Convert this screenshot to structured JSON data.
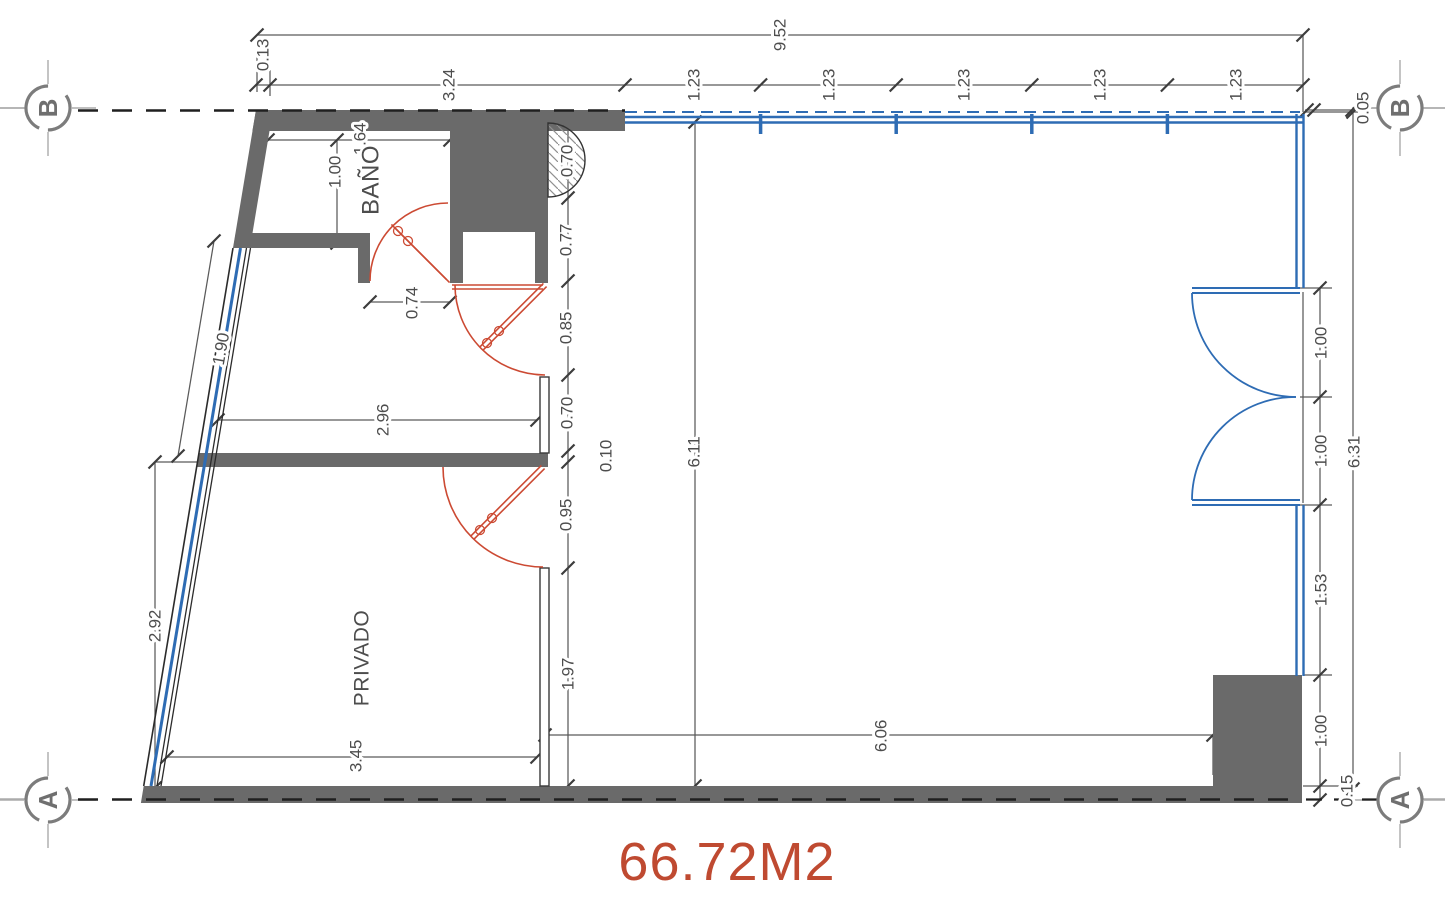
{
  "drawing": {
    "title": "floor plan",
    "area_label": {
      "text": "66.72M2",
      "x": 727,
      "y": 880,
      "size": 54
    },
    "room_labels": [
      {
        "name": "BAÑO",
        "x": 371,
        "y": 180,
        "angle": -90,
        "size": 24
      },
      {
        "name": "PRIVADO",
        "x": 362,
        "y": 658,
        "angle": -90,
        "size": 21
      }
    ],
    "grid_markers": [
      {
        "label": "B",
        "x": 48,
        "y": 108
      },
      {
        "label": "B",
        "x": 1400,
        "y": 108
      },
      {
        "label": "A",
        "x": 48,
        "y": 800
      },
      {
        "label": "A",
        "x": 1400,
        "y": 800
      }
    ],
    "dimensions": [
      {
        "value": "9.52",
        "x": 780,
        "y": 35
      },
      {
        "value": "0.13",
        "x": 263,
        "y": 55
      },
      {
        "value": "3.24",
        "x": 449,
        "y": 85
      },
      {
        "value": "1.23",
        "x": 694,
        "y": 85
      },
      {
        "value": "1.23",
        "x": 829,
        "y": 85
      },
      {
        "value": "1.23",
        "x": 964,
        "y": 85
      },
      {
        "value": "1.23",
        "x": 1100,
        "y": 85
      },
      {
        "value": "1.23",
        "x": 1236,
        "y": 85
      },
      {
        "value": "0.05",
        "x": 1363,
        "y": 108
      },
      {
        "value": "6.31",
        "x": 1354,
        "y": 452
      },
      {
        "value": "1.00",
        "x": 1321,
        "y": 343
      },
      {
        "value": "1.00",
        "x": 1321,
        "y": 451
      },
      {
        "value": "1.53",
        "x": 1321,
        "y": 590
      },
      {
        "value": "1.00",
        "x": 1321,
        "y": 731
      },
      {
        "value": "0.15",
        "x": 1347,
        "y": 791
      },
      {
        "value": "0.70",
        "x": 567,
        "y": 161
      },
      {
        "value": "0.77",
        "x": 566,
        "y": 240
      },
      {
        "value": "0.85",
        "x": 566,
        "y": 328
      },
      {
        "value": "0.70",
        "x": 567,
        "y": 413
      },
      {
        "value": "0.10",
        "x": 606,
        "y": 456
      },
      {
        "value": "0.95",
        "x": 566,
        "y": 515
      },
      {
        "value": "1.97",
        "x": 568,
        "y": 674
      },
      {
        "value": "6.11",
        "x": 694,
        "y": 452
      },
      {
        "value": "2.92",
        "x": 155,
        "y": 626
      },
      {
        "value": "1.90",
        "x": 221,
        "y": 349,
        "angle": -80
      },
      {
        "value": "1.64",
        "x": 360,
        "y": 139
      },
      {
        "value": "1.00",
        "x": 335,
        "y": 172
      },
      {
        "value": "0.74",
        "x": 412,
        "y": 303
      },
      {
        "value": "2.96",
        "x": 383,
        "y": 420
      },
      {
        "value": "3.45",
        "x": 356,
        "y": 756
      },
      {
        "value": "6.06",
        "x": 881,
        "y": 736
      }
    ],
    "colors": {
      "wall": "#6a6a6a",
      "glass": "#2e6cb4",
      "door": "#cc4a33",
      "dim_line": "#5a5a5a",
      "dim_tick": "#3d3d3d",
      "dim_text": "#4d4d4d",
      "grid": "#7c7c7c",
      "grid_light": "#ababab",
      "dash": "#1f1f1f",
      "area": "#bf4a31",
      "thin_wall": "#3a3a3a"
    }
  }
}
